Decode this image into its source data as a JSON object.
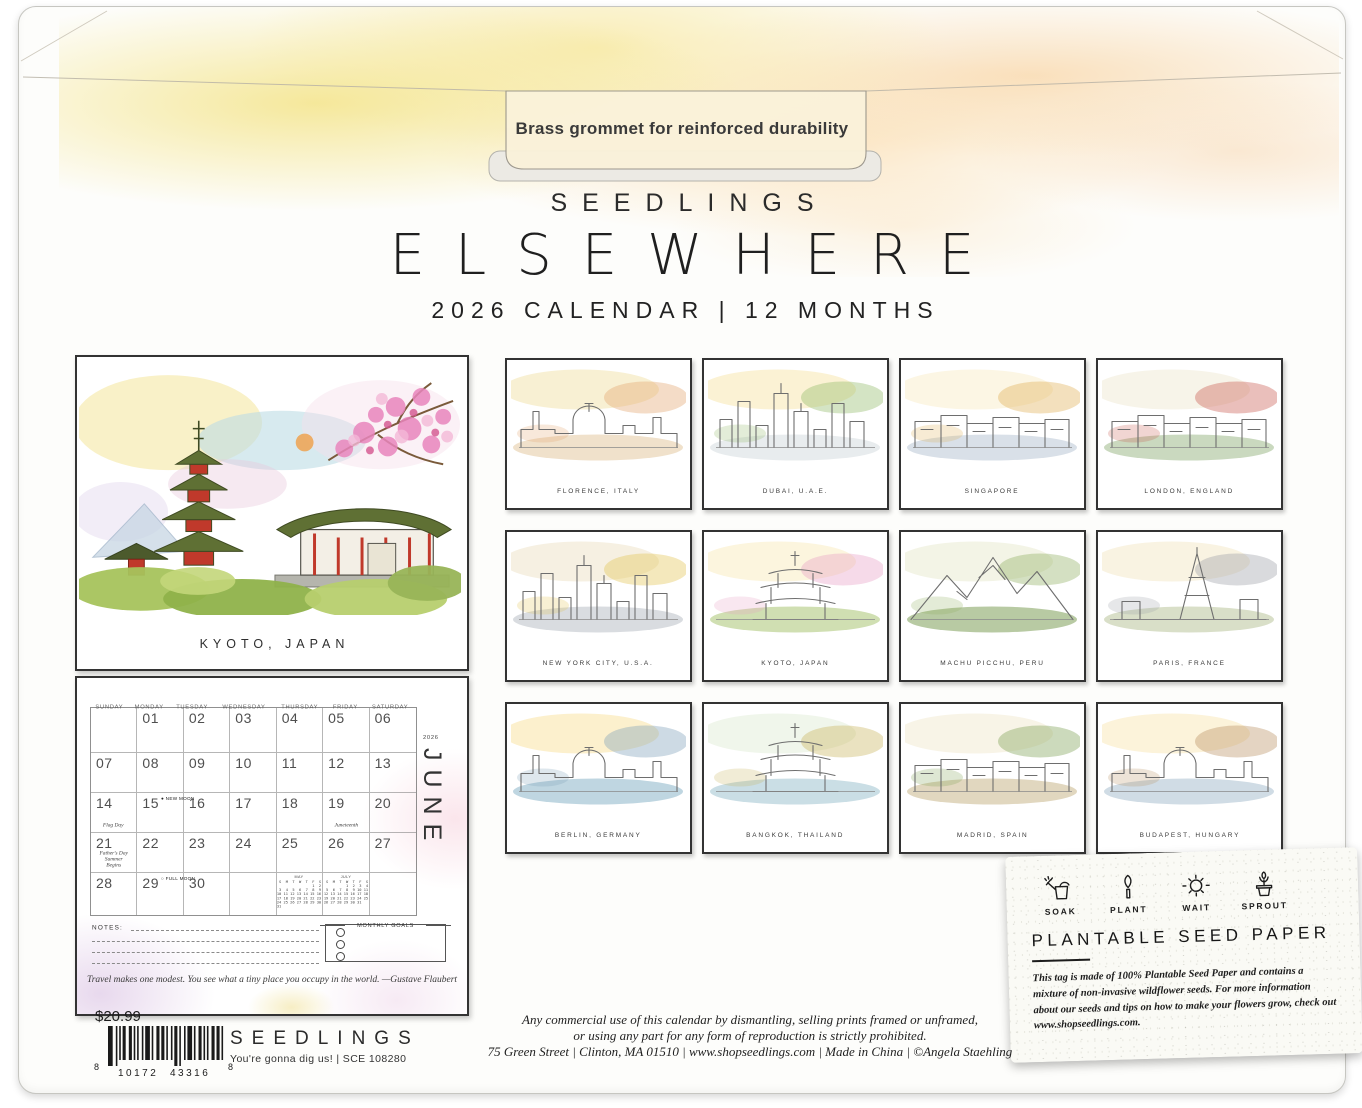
{
  "envelope": {
    "grommet_note": "Brass grommet for reinforced durability",
    "brand": "SEEDLINGS",
    "title": "ELSEWHERE",
    "subtitle": "2026 CALENDAR | 12 MONTHS"
  },
  "featured": {
    "label": "KYOTO, JAPAN"
  },
  "calendar": {
    "year_label": "2026",
    "month_label": "JUNE",
    "day_headers": [
      "SUNDAY",
      "MONDAY",
      "TUESDAY",
      "WEDNESDAY",
      "THURSDAY",
      "FRIDAY",
      "SATURDAY"
    ],
    "weeks": [
      [
        {
          "n": ""
        },
        {
          "n": "01"
        },
        {
          "n": "02"
        },
        {
          "n": "03"
        },
        {
          "n": "04"
        },
        {
          "n": "05"
        },
        {
          "n": "06"
        }
      ],
      [
        {
          "n": "07"
        },
        {
          "n": "08"
        },
        {
          "n": "09"
        },
        {
          "n": "10"
        },
        {
          "n": "11"
        },
        {
          "n": "12"
        },
        {
          "n": "13"
        }
      ],
      [
        {
          "n": "14",
          "note": "Flag Day"
        },
        {
          "n": "15",
          "moon": "● NEW MOON"
        },
        {
          "n": "16"
        },
        {
          "n": "17"
        },
        {
          "n": "18"
        },
        {
          "n": "19",
          "note": "Juneteenth"
        },
        {
          "n": "20"
        }
      ],
      [
        {
          "n": "21",
          "note": "Father's Day\nSummer Begins"
        },
        {
          "n": "22"
        },
        {
          "n": "23"
        },
        {
          "n": "24"
        },
        {
          "n": "25"
        },
        {
          "n": "26"
        },
        {
          "n": "27"
        }
      ],
      [
        {
          "n": "28"
        },
        {
          "n": "29",
          "moon": "○ FULL MOON"
        },
        {
          "n": "30"
        },
        {
          "n": ""
        },
        {
          "mini": 0
        },
        {
          "mini": 1
        },
        {
          "n": ""
        }
      ]
    ],
    "mini_months": [
      {
        "name": "MAY",
        "days": [
          "S",
          "M",
          "T",
          "W",
          "T",
          "F",
          "S"
        ],
        "weeks": [
          [
            "",
            "",
            "",
            "",
            "",
            "1",
            "2"
          ],
          [
            "3",
            "4",
            "5",
            "6",
            "7",
            "8",
            "9"
          ],
          [
            "10",
            "11",
            "12",
            "13",
            "14",
            "15",
            "16"
          ],
          [
            "17",
            "18",
            "19",
            "20",
            "21",
            "22",
            "23"
          ],
          [
            "24",
            "25",
            "26",
            "27",
            "28",
            "29",
            "30"
          ],
          [
            "31",
            "",
            "",
            "",
            "",
            "",
            ""
          ]
        ]
      },
      {
        "name": "JULY",
        "days": [
          "S",
          "M",
          "T",
          "W",
          "T",
          "F",
          "S"
        ],
        "weeks": [
          [
            "",
            "",
            "",
            "1",
            "2",
            "3",
            "4"
          ],
          [
            "5",
            "6",
            "7",
            "8",
            "9",
            "10",
            "11"
          ],
          [
            "12",
            "13",
            "14",
            "15",
            "16",
            "17",
            "18"
          ],
          [
            "19",
            "20",
            "21",
            "22",
            "23",
            "24",
            "25"
          ],
          [
            "26",
            "27",
            "28",
            "29",
            "30",
            "31",
            ""
          ]
        ]
      }
    ],
    "notes_label": "NOTES:",
    "goals_label": "MONTHLY GOALS",
    "quote": "Travel makes one modest. You see what a tiny place you occupy in the world. —Gustave Flaubert"
  },
  "thumbnails": [
    {
      "label": "FLORENCE, ITALY",
      "shape": "dome",
      "palette": {
        "sky": "#f5e9c0",
        "accent": "#e2a36b",
        "ground": "#e3c9a0"
      }
    },
    {
      "label": "DUBAI, U.A.E.",
      "shape": "towers",
      "palette": {
        "sky": "#f9ecc2",
        "accent": "#8fb763",
        "ground": "#d6dce0"
      }
    },
    {
      "label": "SINGAPORE",
      "shape": "row",
      "palette": {
        "sky": "#fbf2d8",
        "accent": "#dfae52",
        "ground": "#b9c7d6"
      }
    },
    {
      "label": "LONDON, ENGLAND",
      "shape": "row",
      "palette": {
        "sky": "#f4efe0",
        "accent": "#c7574b",
        "ground": "#9fb98a"
      }
    },
    {
      "label": "NEW YORK CITY, U.S.A.",
      "shape": "towers",
      "palette": {
        "sky": "#f2e9d6",
        "accent": "#e2c24e",
        "ground": "#b9bfc7"
      }
    },
    {
      "label": "KYOTO, JAPAN",
      "shape": "pagoda",
      "palette": {
        "sky": "#fbf1d0",
        "accent": "#e79ec4",
        "ground": "#a9c472"
      }
    },
    {
      "label": "MACHU PICCHU, PERU",
      "shape": "mountain",
      "palette": {
        "sky": "#eef0dc",
        "accent": "#8fae5f",
        "ground": "#7d9e57"
      }
    },
    {
      "label": "PARIS, FRANCE",
      "shape": "eiffel",
      "palette": {
        "sky": "#f7eed6",
        "accent": "#9a9ea6",
        "ground": "#b9c49a"
      }
    },
    {
      "label": "BERLIN, GERMANY",
      "shape": "dome",
      "palette": {
        "sky": "#fbe9b8",
        "accent": "#7b9fb8",
        "ground": "#8ab4c8"
      }
    },
    {
      "label": "BANGKOK, THAILAND",
      "shape": "pagoda",
      "palette": {
        "sky": "#eaf2e3",
        "accent": "#c9b35a",
        "ground": "#9fc3cf"
      }
    },
    {
      "label": "MADRID, SPAIN",
      "shape": "row",
      "palette": {
        "sky": "#f5f0dd",
        "accent": "#7a9e4f",
        "ground": "#c9b68a"
      }
    },
    {
      "label": "BUDAPEST, HUNGARY",
      "shape": "dome",
      "palette": {
        "sky": "#fbeeca",
        "accent": "#b98f5e",
        "ground": "#a9bfd0"
      }
    }
  ],
  "seed_tag": {
    "steps": [
      {
        "label": "SOAK",
        "icon": "watering-can-icon"
      },
      {
        "label": "PLANT",
        "icon": "trowel-icon"
      },
      {
        "label": "WAIT",
        "icon": "sun-icon"
      },
      {
        "label": "SPROUT",
        "icon": "sprout-pot-icon"
      }
    ],
    "title": "PLANTABLE SEED PAPER",
    "body": "This tag is made of 100% Plantable Seed Paper and contains a mixture of non-invasive wildflower seeds. For more information about our seeds and tips on how to make your flowers grow, check out www.shopseedlings.com."
  },
  "footer": {
    "price": "$20.99",
    "barcode": {
      "left_digit": "8",
      "group1": "10172",
      "group2": "43316",
      "right_digit": "8"
    },
    "brand": "SEEDLINGS",
    "tagline": "You're gonna dig us! | SCE 108280",
    "legal_line1": "Any commercial use of this calendar by dismantling, selling prints framed or unframed,",
    "legal_line2": "or using any part for any form of reproduction is strictly prohibited.",
    "address": "75 Green Street | Clinton, MA 01510 | www.shopseedlings.com | Made in China | ©Angela Staehling"
  }
}
